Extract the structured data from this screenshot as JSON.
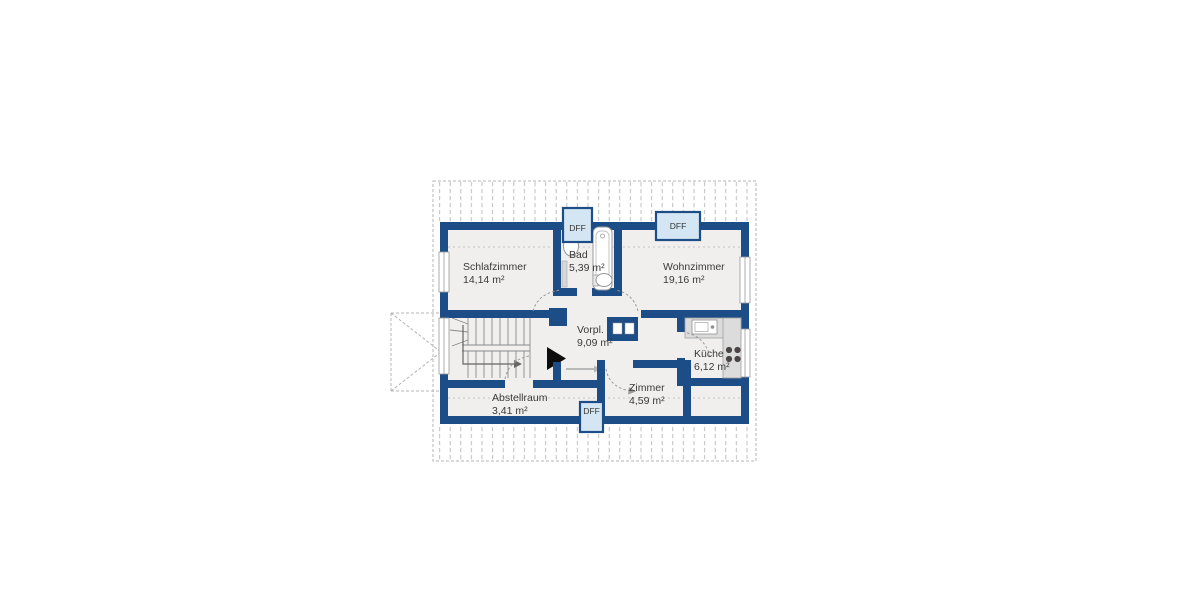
{
  "plan": {
    "type": "apartment-floor-plan",
    "language": "de",
    "rooms": [
      {
        "name": "Schlafzimmer",
        "area": "14,14 m²"
      },
      {
        "name": "Bad",
        "area": "5,39 m²"
      },
      {
        "name": "Wohnzimmer",
        "area": "19,16 m²"
      },
      {
        "name": "Vorpl.",
        "area": "9,09 m²"
      },
      {
        "name": "Küche",
        "area": "6,12 m²"
      },
      {
        "name": "Zimmer",
        "area": "4,59 m²"
      },
      {
        "name": "Abstellraum",
        "area": "3,41 m²"
      }
    ],
    "roof_windows": [
      {
        "label": "DFF"
      },
      {
        "label": "DFF"
      },
      {
        "label": "DFF"
      }
    ],
    "colors": {
      "wall": "#1d4d86",
      "floor": "#f0efee",
      "roof_window_fill": "#d4e6f3",
      "counter": "#dcdcdc",
      "text": "#3a3a3a"
    }
  }
}
